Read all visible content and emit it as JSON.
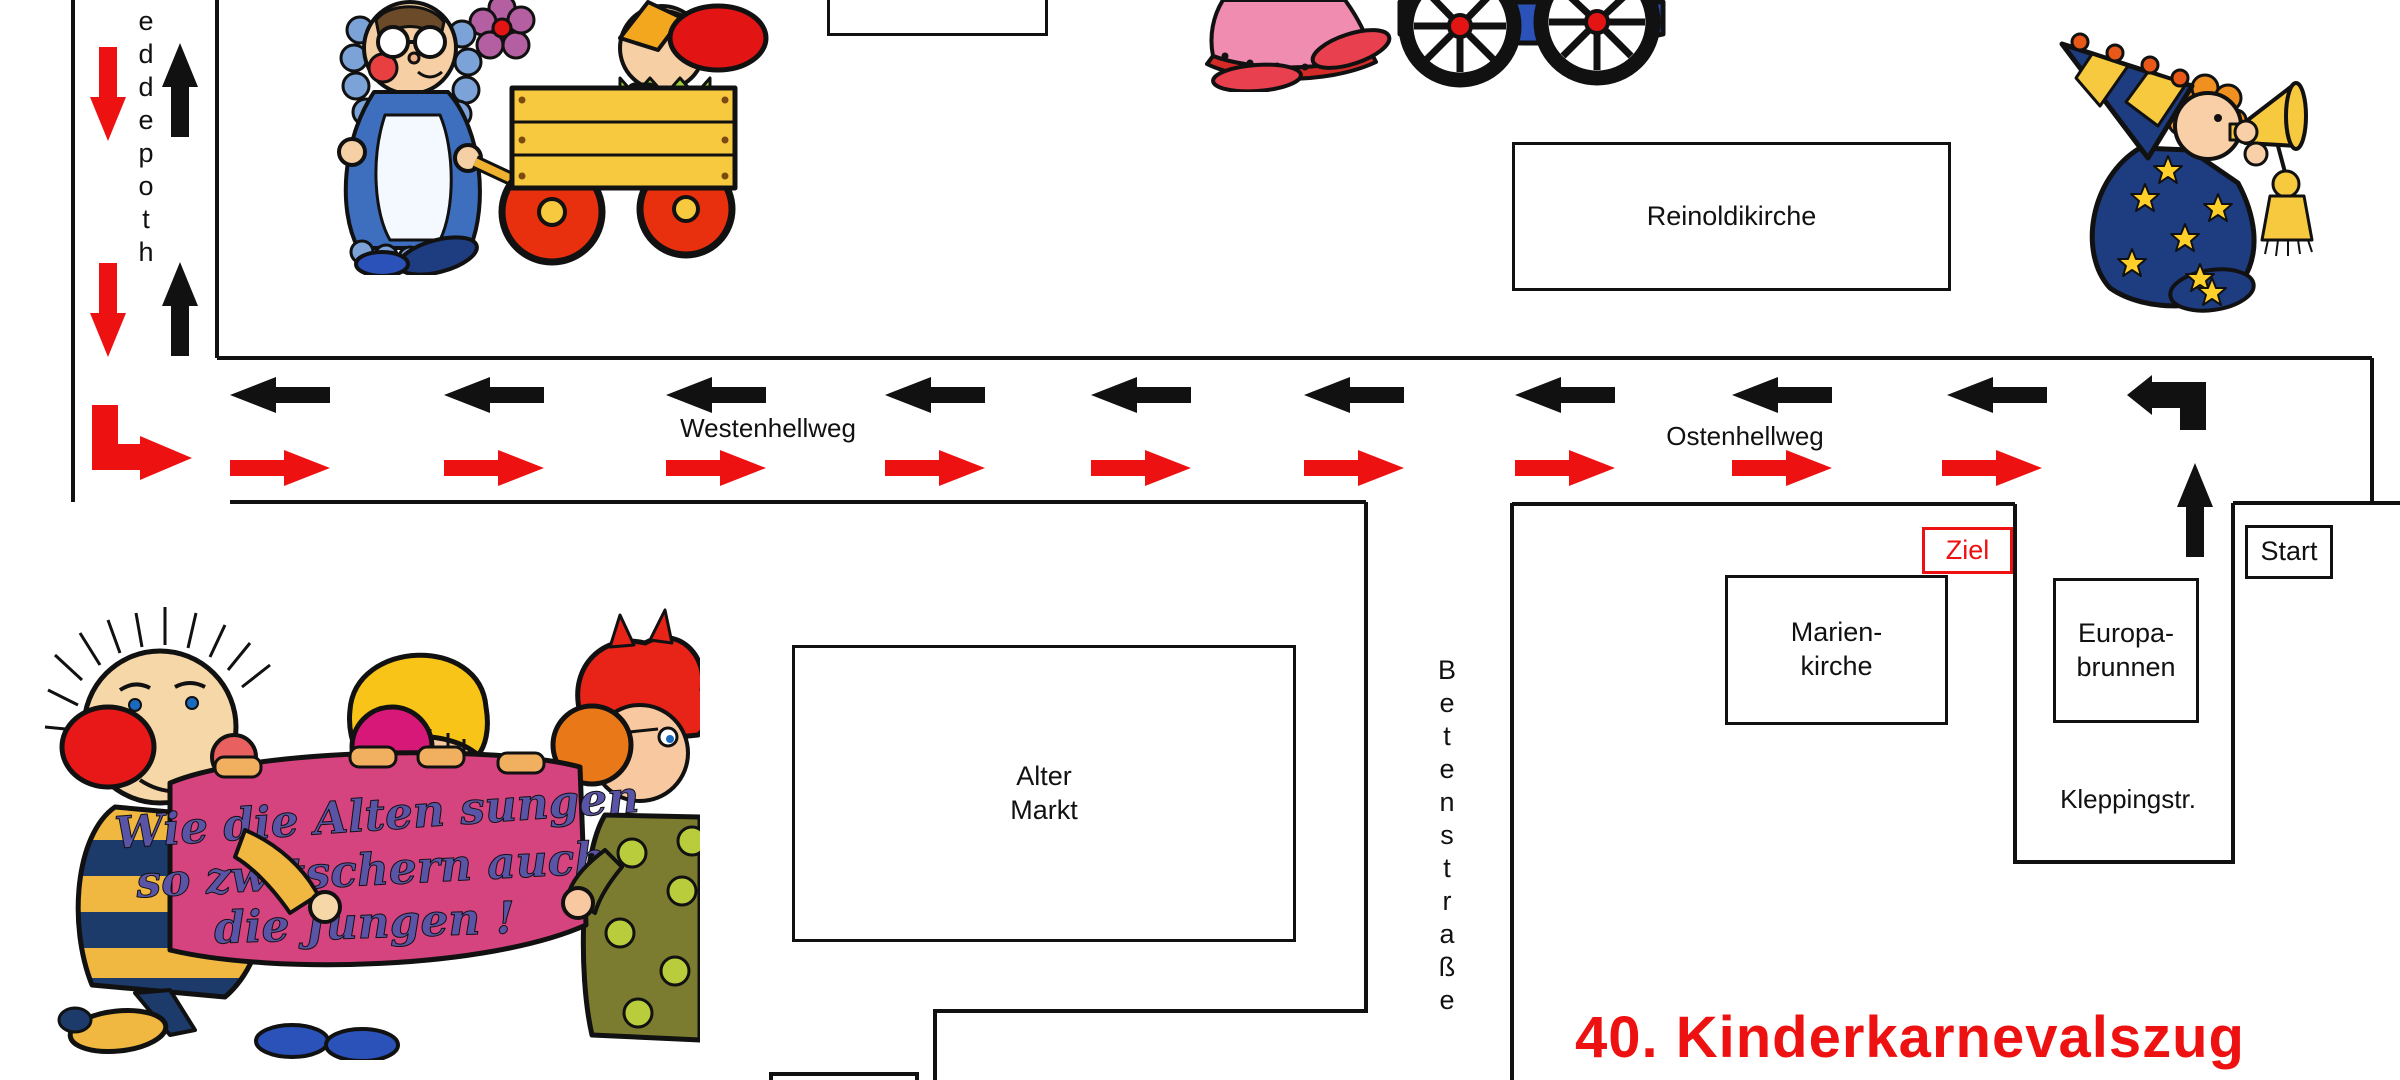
{
  "map": {
    "title": "40. Kinderkarnevalszug",
    "title_color": "#ee1111"
  },
  "streets": {
    "left_street_vertical": "eddepoth",
    "westenhellweg": "Westenhellweg",
    "ostenhellweg": "Ostenhellweg",
    "betenstrasse": "Betenstraße",
    "kleppingstr": "Kleppingstr."
  },
  "places": {
    "reinoldikirche": "Reinoldikirche",
    "marienkirche1": "Marien-",
    "marienkirche2": "kirche",
    "europabrunnen1": "Europa-",
    "europabrunnen2": "brunnen",
    "altermarkt1": "Alter",
    "altermarkt2": "Markt"
  },
  "route": {
    "start": "Start",
    "ziel": "Ziel",
    "outbound_color": "#ee1111",
    "return_color": "#111111"
  },
  "banner": {
    "line1": "Wie die Alten sungen",
    "line2": "so zwitschern auch",
    "line3": "die Jungen !",
    "banner_color": "#d5447e",
    "text_color": "#5a54a6"
  }
}
